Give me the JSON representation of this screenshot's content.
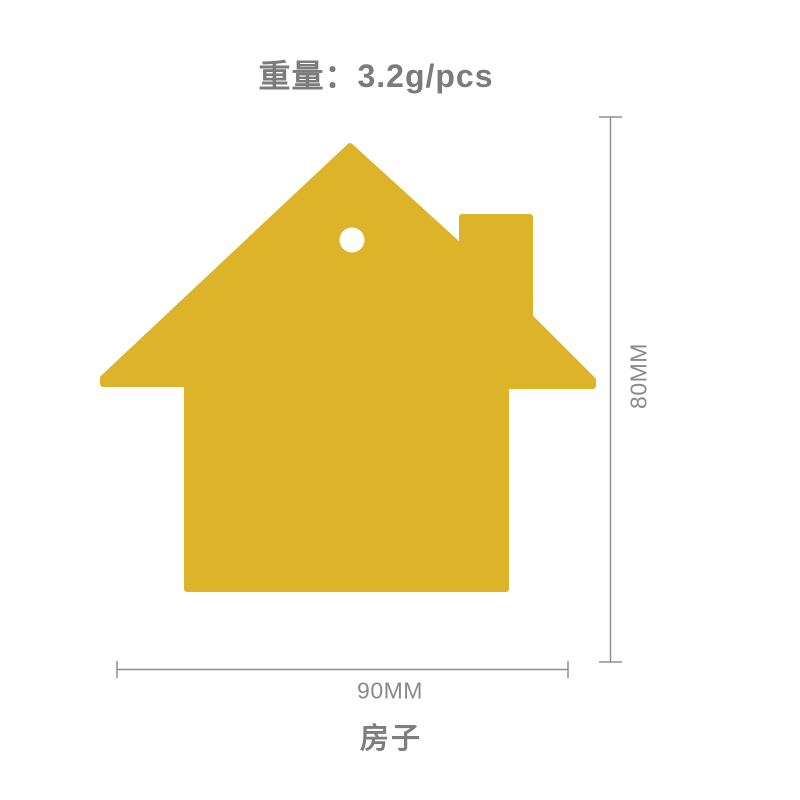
{
  "product": {
    "weight_label": "重量：3.2g/pcs",
    "name": "房子",
    "shape": "house-silhouette-with-chimney-and-hanging-hole",
    "color": "#ddb32a"
  },
  "dimensions": {
    "height_label": "80MM",
    "width_label": "90MM",
    "line_color": "#8f8f8f",
    "label_color": "#8a8a8a"
  }
}
